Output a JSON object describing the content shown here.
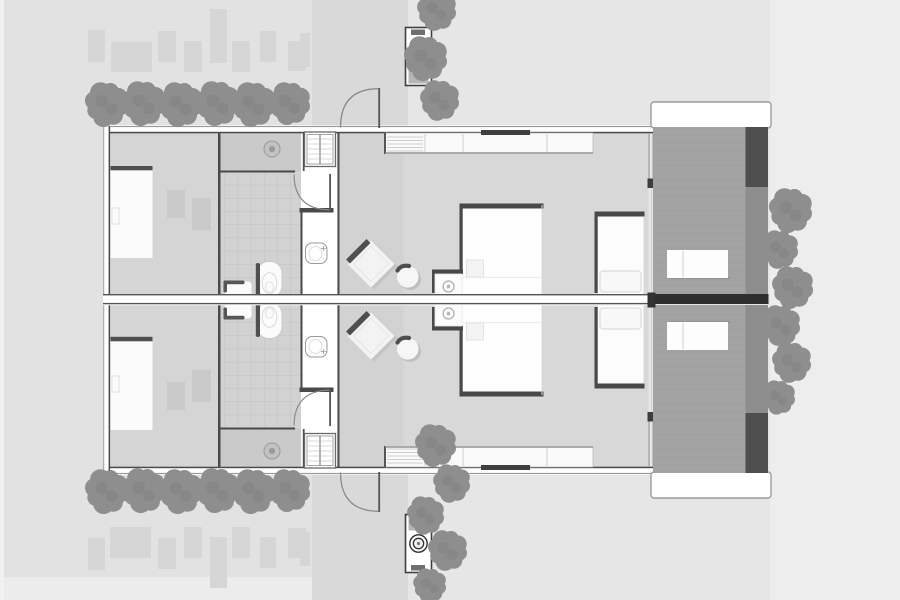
{
  "drawing": {
    "kind": "architectural-floor-plan",
    "units": [
      "upper-villa-unit",
      "lower-villa-unit"
    ]
  },
  "palette": {
    "bg_base": "#e6e6e6",
    "bg_left": "#e2e2e2",
    "bg_path": "#d9d9d9",
    "bg_right": "#ededed",
    "bg_edge": "#f1f1f1",
    "paver": "#d6d6d6",
    "tree": "#8e8e8e",
    "tree_dark": "#7c7c7c",
    "wall": "#4a4a4a",
    "wall_light": "#9a9a9a",
    "floor_room": "#d5d5d5",
    "floor_bath": "#d2d2d2",
    "floor_shower": "#cacaca",
    "floor_bed": "#d8d8d8",
    "floor_breeze": "#d2d2d2",
    "tile_line": "#bfbfbf",
    "white": "#ffffff",
    "furniture": "#fbfbfb",
    "furn_dark": "#4f4f4f",
    "shadow": "#bfbfbf",
    "deck": "#a3a3a3",
    "deck_col": "#8d8d8d",
    "band_dark": "#4e4e4e",
    "axis_dark": "#2e2e2e",
    "mat": "#c9c9c9",
    "fixture": "#c2c2c2"
  },
  "site": {
    "trees_top_row": [
      [
        107,
        104,
        21
      ],
      [
        144,
        103,
        21
      ],
      [
        181,
        104,
        21
      ],
      [
        218,
        103,
        21
      ],
      [
        254,
        104,
        21
      ],
      [
        290,
        103,
        20
      ]
    ],
    "trees_bottom_row": [
      [
        107,
        491,
        21
      ],
      [
        144,
        490,
        21
      ],
      [
        181,
        491,
        21
      ],
      [
        218,
        490,
        21
      ],
      [
        254,
        491,
        21
      ],
      [
        290,
        490,
        20
      ]
    ],
    "trees_center_top": [
      [
        437,
        10,
        19
      ],
      [
        426,
        58,
        21
      ],
      [
        440,
        100,
        19
      ]
    ],
    "trees_center_bottom": [
      [
        436,
        445,
        20
      ],
      [
        452,
        483,
        18
      ],
      [
        426,
        515,
        18
      ],
      [
        448,
        550,
        19
      ],
      [
        430,
        585,
        16
      ]
    ],
    "trees_right_col": [
      [
        791,
        210,
        21
      ],
      [
        780,
        249,
        18
      ],
      [
        793,
        287,
        20
      ],
      [
        781,
        325,
        19
      ],
      [
        792,
        362,
        19
      ],
      [
        779,
        397,
        16
      ]
    ],
    "pavers_top": [
      [
        88,
        30,
        17,
        32
      ],
      [
        111,
        42,
        41,
        30
      ],
      [
        158,
        31,
        18,
        31
      ],
      [
        184,
        41,
        18,
        31
      ],
      [
        210,
        9,
        17,
        54
      ],
      [
        232,
        41,
        18,
        31
      ],
      [
        260,
        31,
        16,
        31
      ],
      [
        288,
        41,
        18,
        30
      ],
      [
        300,
        33,
        10,
        34
      ]
    ],
    "pavers_bottom": [
      [
        88,
        538,
        17,
        32
      ],
      [
        110,
        527,
        41,
        31
      ],
      [
        158,
        538,
        18,
        31
      ],
      [
        184,
        527,
        18,
        31
      ],
      [
        210,
        537,
        17,
        51
      ],
      [
        232,
        527,
        18,
        31
      ],
      [
        260,
        537,
        16,
        31
      ],
      [
        288,
        528,
        18,
        30
      ],
      [
        300,
        532,
        10,
        34
      ]
    ]
  }
}
